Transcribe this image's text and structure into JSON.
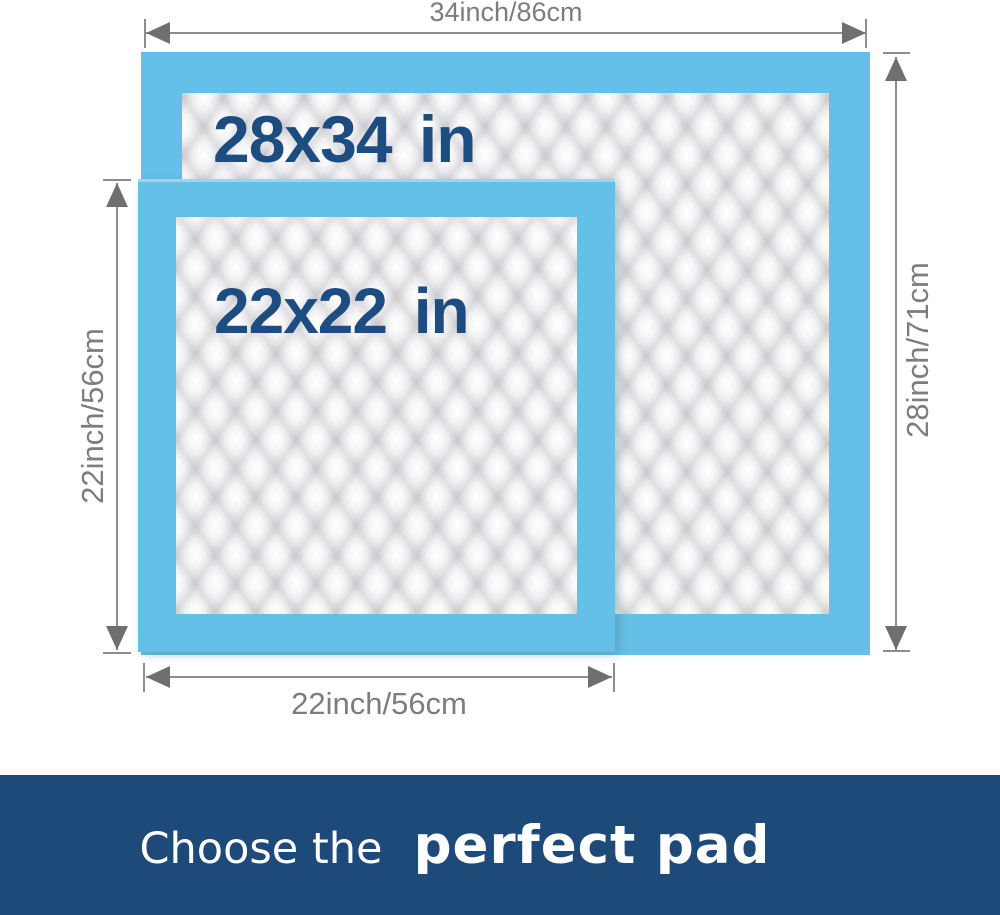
{
  "diagram": {
    "large_pad": {
      "size_label": "28x34 in",
      "top_dimension": "34inch/86cm",
      "right_dimension": "28inch/71cm"
    },
    "small_pad": {
      "size_label": "22x22 in",
      "left_dimension": "22inch/56cm",
      "bottom_dimension": "22inch/56cm"
    }
  },
  "banner": {
    "prefix": "Choose the",
    "highlight": "perfect pad"
  },
  "colors": {
    "pad_border_blue": "#64c0e6",
    "pad_label_navy": "#1d4d80",
    "dimension_gray": "#7d7d7d",
    "banner_navy": "#1d4a78",
    "banner_text": "#ffffff"
  }
}
